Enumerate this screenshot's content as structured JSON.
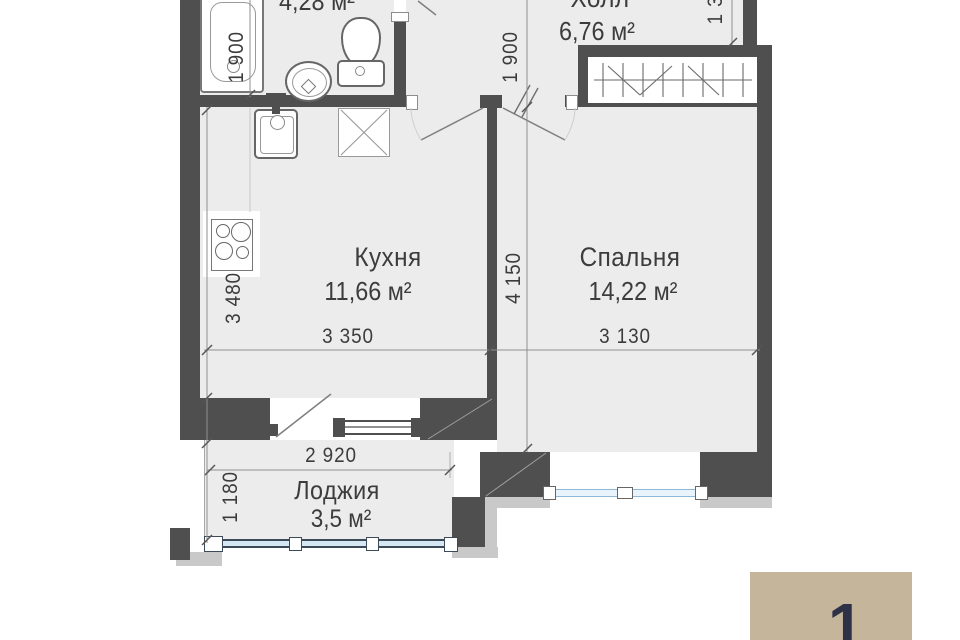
{
  "rooms": {
    "bathroom": {
      "area": "4,28 м²"
    },
    "hall": {
      "name": "Холл",
      "area": "6,76 м²"
    },
    "kitchen": {
      "name": "Кухня",
      "area": "11,66 м²"
    },
    "bedroom": {
      "name": "Спальня",
      "area": "14,22 м²"
    },
    "loggia": {
      "name": "Лоджия",
      "area": "3,5 м²"
    }
  },
  "dimensions": {
    "bathroom_height": "1 900",
    "hall_height": "1 900",
    "kitchen_height": "3 480",
    "bedroom_height": "4 150",
    "kitchen_width": "3 350",
    "bedroom_width": "3 130",
    "loggia_width": "2 920",
    "loggia_height": "1 180",
    "top_right_partial": "1 3"
  },
  "badge": {
    "number": "1"
  },
  "colors": {
    "wall": "#4f4f4f",
    "floor": "#ececec",
    "exterior_band": "#c9c9c9",
    "window_blue": "#d6e7f4",
    "badge_bg": "#c5b59b",
    "badge_text": "#2f3147"
  }
}
